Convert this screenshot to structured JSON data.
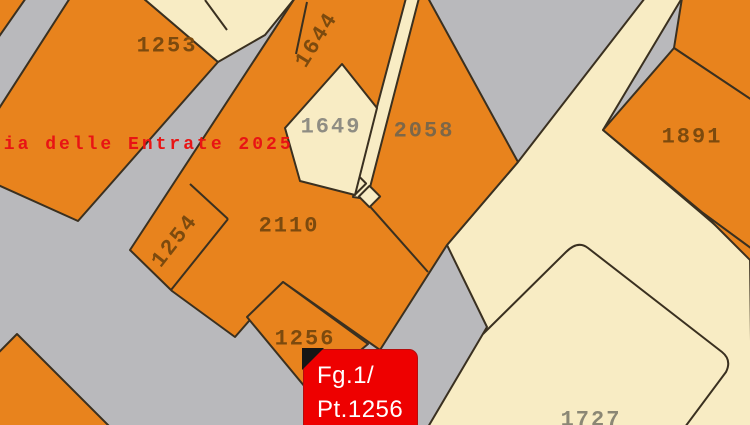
{
  "map": {
    "watermark": "zia delle Entrate 2025",
    "parcels": {
      "1253": {
        "label": "1253"
      },
      "1644": {
        "label": "1644"
      },
      "1649": {
        "label": "1649"
      },
      "2058": {
        "label": "2058"
      },
      "1891": {
        "label": "1891"
      },
      "1254": {
        "label": "1254"
      },
      "2110": {
        "label": "2110"
      },
      "1256": {
        "label": "1256"
      },
      "1727": {
        "label": "1727"
      }
    },
    "marker": {
      "line1": "Fg.1/",
      "line2": "Pt.1256"
    },
    "colors": {
      "background_gray": "#b9b9bc",
      "parcel_orange": "#e8831d",
      "parcel_cream": "#f8ecc4",
      "boundary_line": "#3a3020",
      "label_brown": "#7c4a0e",
      "label_gray": "#8f8d83",
      "watermark_red": "#e81414",
      "marker_red": "#ee0000",
      "marker_text": "#ffffff"
    }
  }
}
